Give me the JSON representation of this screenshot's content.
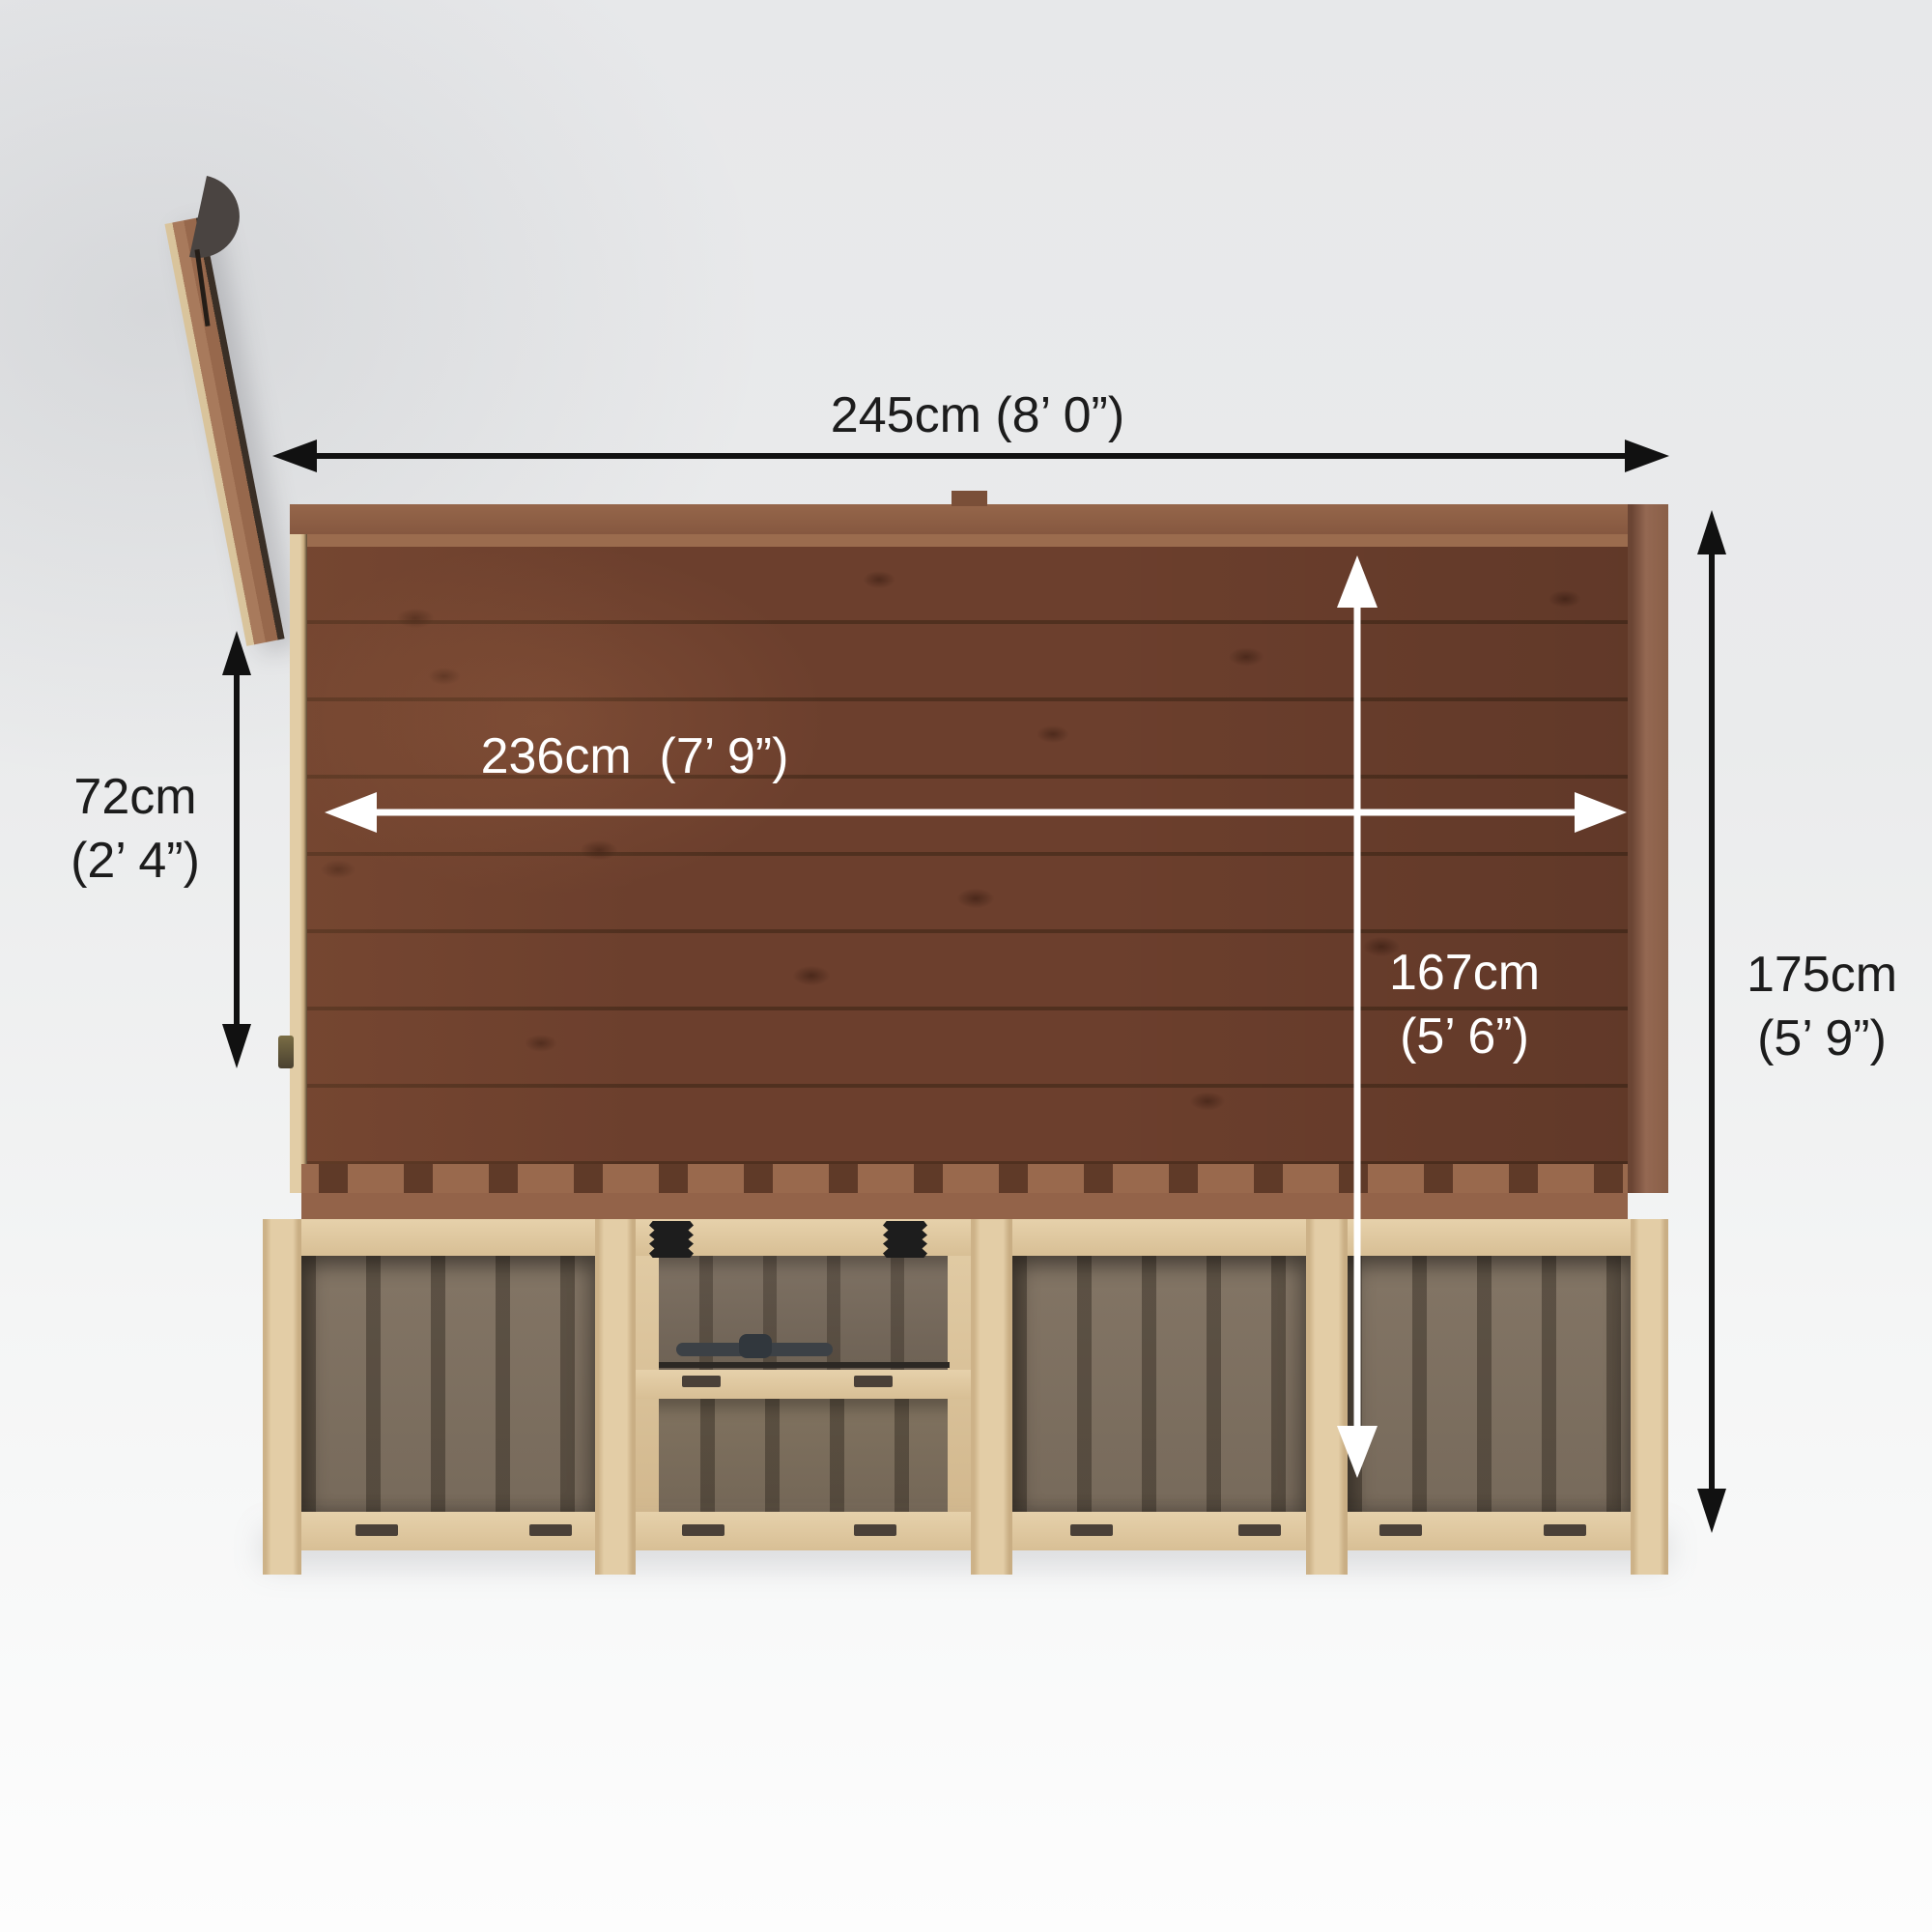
{
  "view": {
    "description": "Top-down dimension diagram of a wooden pent summerhouse with open door and front window"
  },
  "annotations": {
    "total_width": {
      "text": "245cm (8’ 0”)",
      "orientation": "horizontal",
      "style": "black-outside"
    },
    "internal_width": {
      "text": "236cm  (7’ 9”)",
      "orientation": "horizontal",
      "style": "white-inside"
    },
    "door_width": {
      "text": "72cm\n(2’ 4”)",
      "orientation": "vertical",
      "style": "black-outside"
    },
    "internal_depth": {
      "text": "167cm\n(5’ 6”)",
      "orientation": "vertical",
      "style": "white-inside"
    },
    "total_depth": {
      "text": "175cm\n(5’ 9”)",
      "orientation": "vertical",
      "style": "black-outside"
    }
  },
  "colors": {
    "background_top": "#e7e8ea",
    "background_bottom": "#fdfdfd",
    "roof_plank_brown": "#6c3f2d",
    "roof_plank_seam": "#50301f",
    "roof_fascia": "#95664a",
    "frame_cream_wood": "#e0caa3",
    "wall_panel_taupe": "#7d6f60",
    "wall_panel_stripe": "#5e5347",
    "hardware_black": "#1d1d1d",
    "arrow_black": "#111111",
    "arrow_white": "#ffffff",
    "door_disc_gray": "#4a4441"
  }
}
